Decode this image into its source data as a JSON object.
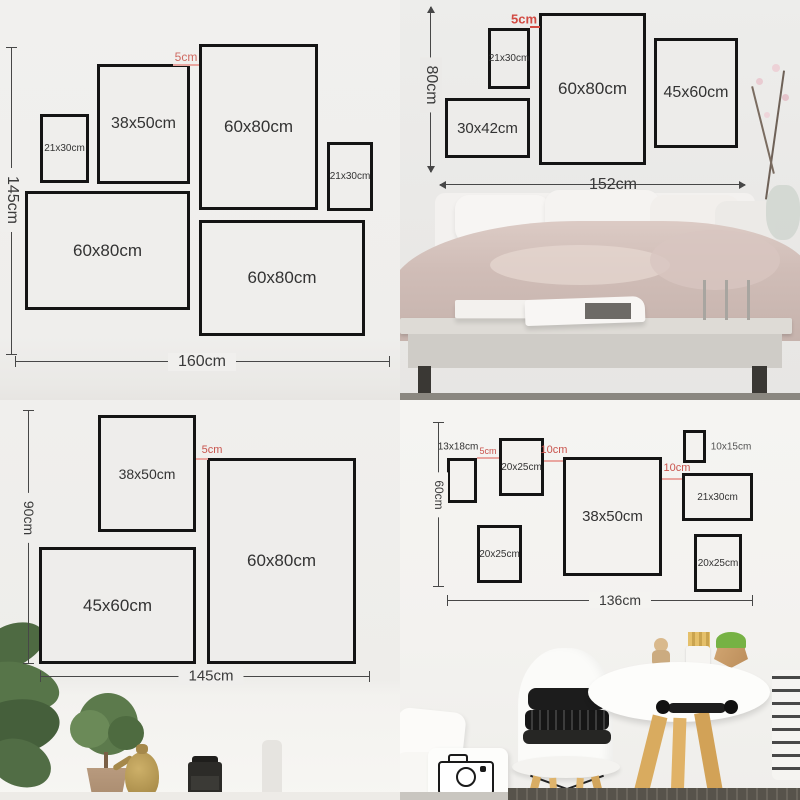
{
  "colors": {
    "accent_red": "#c9544d",
    "gap_line_pink": "#e9a6a0",
    "frame_border": "#141414",
    "dim_line": "#474747",
    "wall_grey": "#efeeec"
  },
  "top_left": {
    "total_height": "145cm",
    "total_width": "160cm",
    "gap": "5cm",
    "frames": [
      {
        "label": "21x30cm"
      },
      {
        "label": "38x50cm"
      },
      {
        "label": "60x80cm"
      },
      {
        "label": "21x30cm"
      },
      {
        "label": "60x80cm"
      },
      {
        "label": "60x80cm"
      }
    ]
  },
  "top_right": {
    "total_height": "80cm",
    "total_width": "152cm",
    "gap": "5cm",
    "frames": [
      {
        "label": "21x30cm"
      },
      {
        "label": "60x80cm"
      },
      {
        "label": "45x60cm"
      },
      {
        "label": "30x42cm"
      }
    ]
  },
  "bottom_left": {
    "total_height": "90cm",
    "total_width": "145cm",
    "gap": "5cm",
    "frames": [
      {
        "label": "38x50cm"
      },
      {
        "label": "60x80cm"
      },
      {
        "label": "45x60cm"
      }
    ]
  },
  "bottom_right": {
    "total_height": "60cm",
    "total_width": "136cm",
    "gap_small": "5cm",
    "gap_mid": "10cm",
    "gap_right": "10cm",
    "frame_label_13x18": "13x18cm",
    "frame_label_10x15": "10x15cm",
    "frames": [
      {
        "label": "20x25cm"
      },
      {
        "label": "38x50cm"
      },
      {
        "label": "21x30cm"
      },
      {
        "label": "20x25cm"
      },
      {
        "label": "20x25cm"
      }
    ]
  }
}
